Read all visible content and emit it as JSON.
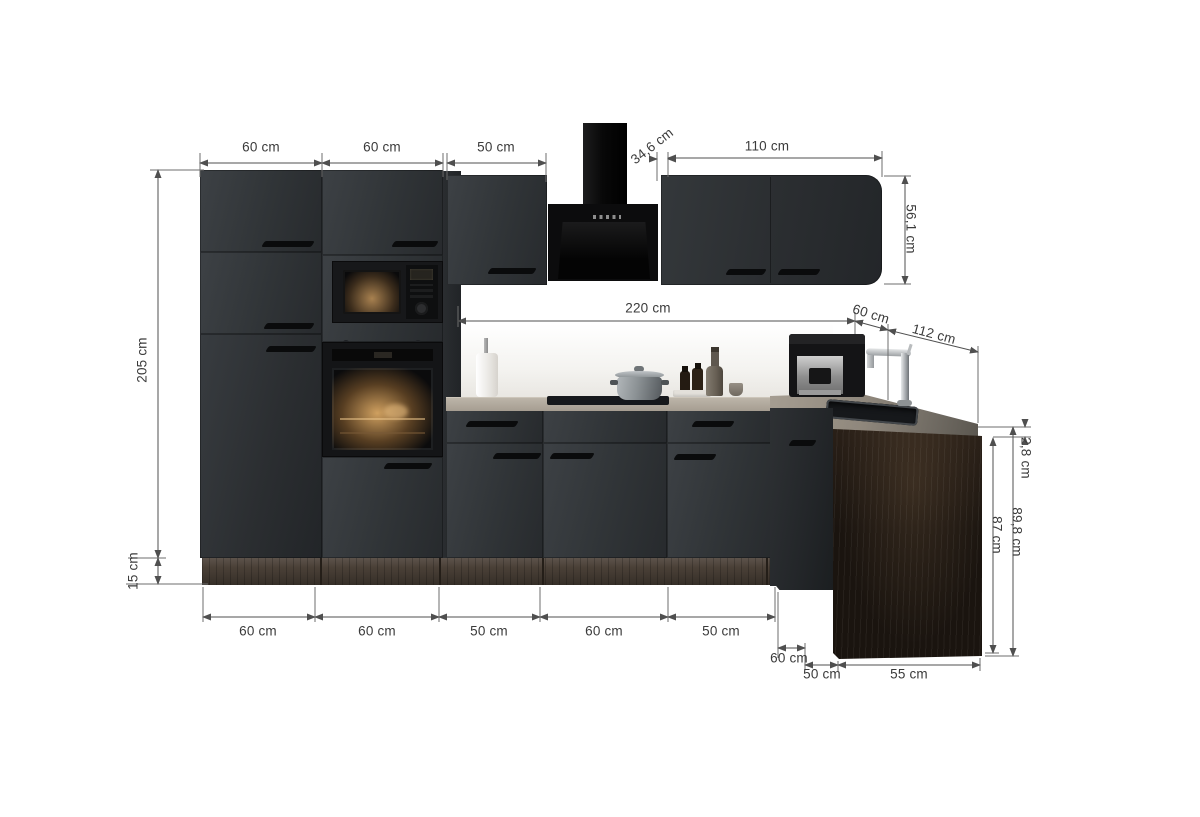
{
  "meta": {
    "type": "product-dimension-diagram",
    "subject": "L-shaped fitted kitchen, anthracite fronts, front elevation with measurement annotations"
  },
  "colors": {
    "background": "#ffffff",
    "cabinet_front": "#33363a",
    "appliance_black": "#111112",
    "worktop_light": "#b0a89c",
    "plinth_wood": "#4a4037",
    "side_panel_wood": "#1a140f",
    "dimension_line": "#4f4f4f",
    "label_text": "#3b3b3b"
  },
  "dims": {
    "wall_cabinet_1_width": "60 cm",
    "wall_cabinet_2_width": "60 cm",
    "wall_cabinet_3_width": "50 cm",
    "hood_offset": "34,6 cm",
    "wall_cabinet_right_width": "110 cm",
    "wall_cabinet_right_height": "56,1 cm",
    "total_height": "205 cm",
    "plinth_height": "15 cm",
    "worktop_run_length": "220 cm",
    "corner_depth": "60 cm",
    "return_length": "112 cm",
    "base_unit_1_width": "60 cm",
    "base_unit_2_width": "60 cm",
    "base_unit_3_width": "50 cm",
    "base_unit_4_width": "60 cm",
    "base_unit_5_width": "50 cm",
    "corner_unit_width": "60 cm",
    "return_unit_1_width": "50 cm",
    "return_unit_2_width": "55 cm",
    "worktop_thickness": "2,8 cm",
    "base_height_carcass": "87 cm",
    "base_height_with_worktop": "89,8 cm"
  }
}
